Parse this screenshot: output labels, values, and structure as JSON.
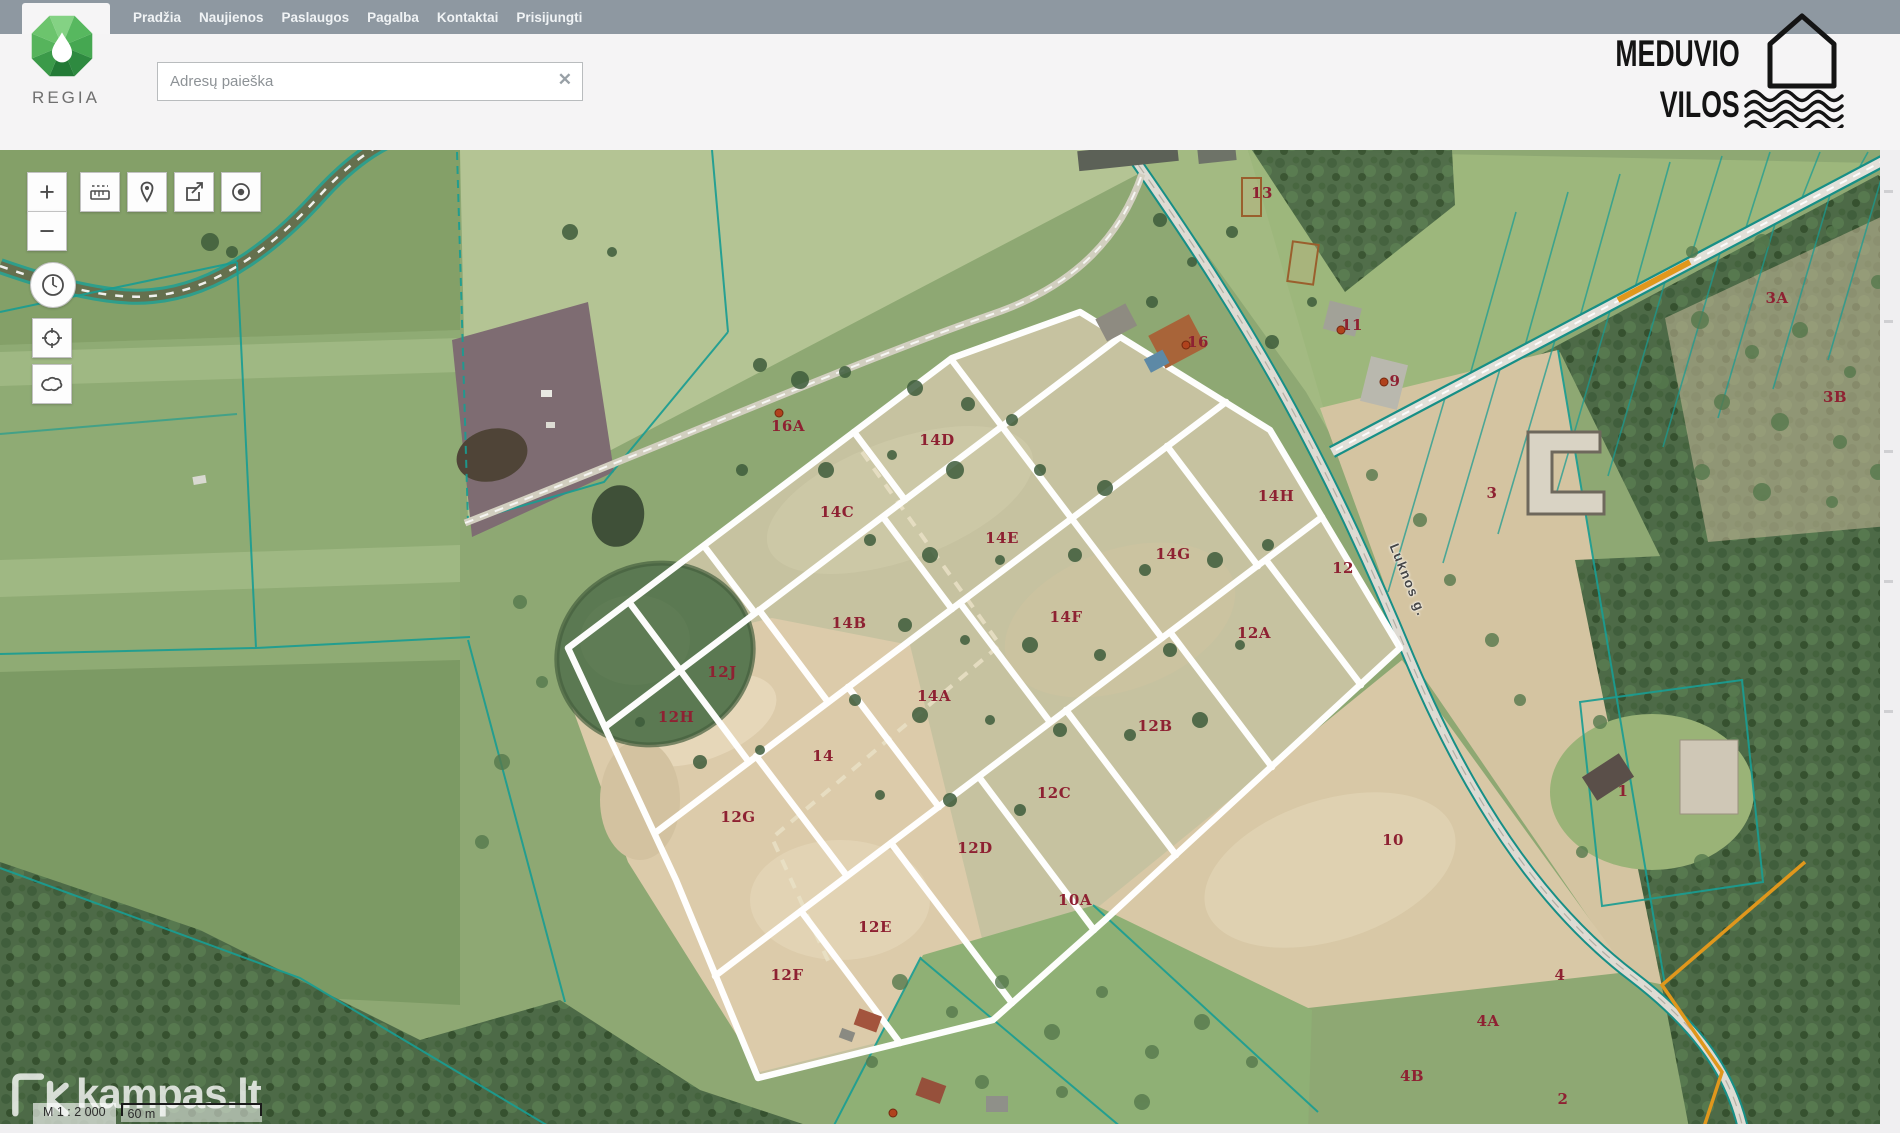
{
  "nav": {
    "bg_color": "#8e98a1",
    "items": [
      "Pradžia",
      "Naujienos",
      "Paslaugos",
      "Pagalba",
      "Kontaktai",
      "Prisijungti"
    ]
  },
  "brand": {
    "name": "REGIA"
  },
  "search": {
    "placeholder": "Adresų paieška",
    "clear_icon": "✕"
  },
  "site_logo": {
    "line1": "MEDUVIO",
    "line2": "VILOS"
  },
  "map_tools": {
    "zoom_in": "+",
    "zoom_out": "−"
  },
  "map": {
    "street_label": "Luknos g.",
    "scale_text": "M 1 : 2 000",
    "scale_bar_text": "60 m",
    "watermark_text": "kampas.lt",
    "parcel_label_color": "#8e2132",
    "marker_color": "#b0421d",
    "cadastral_line_color": "#1a9d93",
    "highlight_boundary_color": "#ffffff",
    "orange_boundary_color": "#e0971c",
    "parcel_labels": [
      {
        "text": "16A",
        "x": 788,
        "y": 426
      },
      {
        "text": "14D",
        "x": 937,
        "y": 440
      },
      {
        "text": "14C",
        "x": 837,
        "y": 512
      },
      {
        "text": "14E",
        "x": 1002,
        "y": 538
      },
      {
        "text": "14G",
        "x": 1173,
        "y": 554
      },
      {
        "text": "14H",
        "x": 1276,
        "y": 496
      },
      {
        "text": "12",
        "x": 1343,
        "y": 568
      },
      {
        "text": "14F",
        "x": 1066,
        "y": 617
      },
      {
        "text": "14B",
        "x": 849,
        "y": 623
      },
      {
        "text": "12A",
        "x": 1254,
        "y": 633
      },
      {
        "text": "12J",
        "x": 722,
        "y": 672
      },
      {
        "text": "12H",
        "x": 676,
        "y": 717
      },
      {
        "text": "14A",
        "x": 934,
        "y": 696
      },
      {
        "text": "14",
        "x": 823,
        "y": 756
      },
      {
        "text": "12B",
        "x": 1155,
        "y": 726
      },
      {
        "text": "12C",
        "x": 1054,
        "y": 793
      },
      {
        "text": "12G",
        "x": 738,
        "y": 817
      },
      {
        "text": "12D",
        "x": 975,
        "y": 848
      },
      {
        "text": "10A",
        "x": 1075,
        "y": 900
      },
      {
        "text": "12E",
        "x": 875,
        "y": 927
      },
      {
        "text": "12F",
        "x": 787,
        "y": 975
      },
      {
        "text": "10",
        "x": 1393,
        "y": 840
      },
      {
        "text": "16",
        "x": 1198,
        "y": 342
      },
      {
        "text": "13",
        "x": 1262,
        "y": 193
      },
      {
        "text": "11",
        "x": 1352,
        "y": 325
      },
      {
        "text": "9",
        "x": 1395,
        "y": 381
      },
      {
        "text": "3A",
        "x": 1777,
        "y": 298
      },
      {
        "text": "3B",
        "x": 1835,
        "y": 397
      },
      {
        "text": "3",
        "x": 1492,
        "y": 493
      },
      {
        "text": "1",
        "x": 1623,
        "y": 791
      },
      {
        "text": "4",
        "x": 1560,
        "y": 975
      },
      {
        "text": "4A",
        "x": 1488,
        "y": 1021
      },
      {
        "text": "4B",
        "x": 1412,
        "y": 1076
      },
      {
        "text": "2",
        "x": 1563,
        "y": 1099
      }
    ],
    "markers": [
      {
        "x": 779,
        "y": 413
      },
      {
        "x": 1186,
        "y": 345
      },
      {
        "x": 1341,
        "y": 330
      },
      {
        "x": 1384,
        "y": 382
      },
      {
        "x": 893,
        "y": 1113
      }
    ]
  }
}
